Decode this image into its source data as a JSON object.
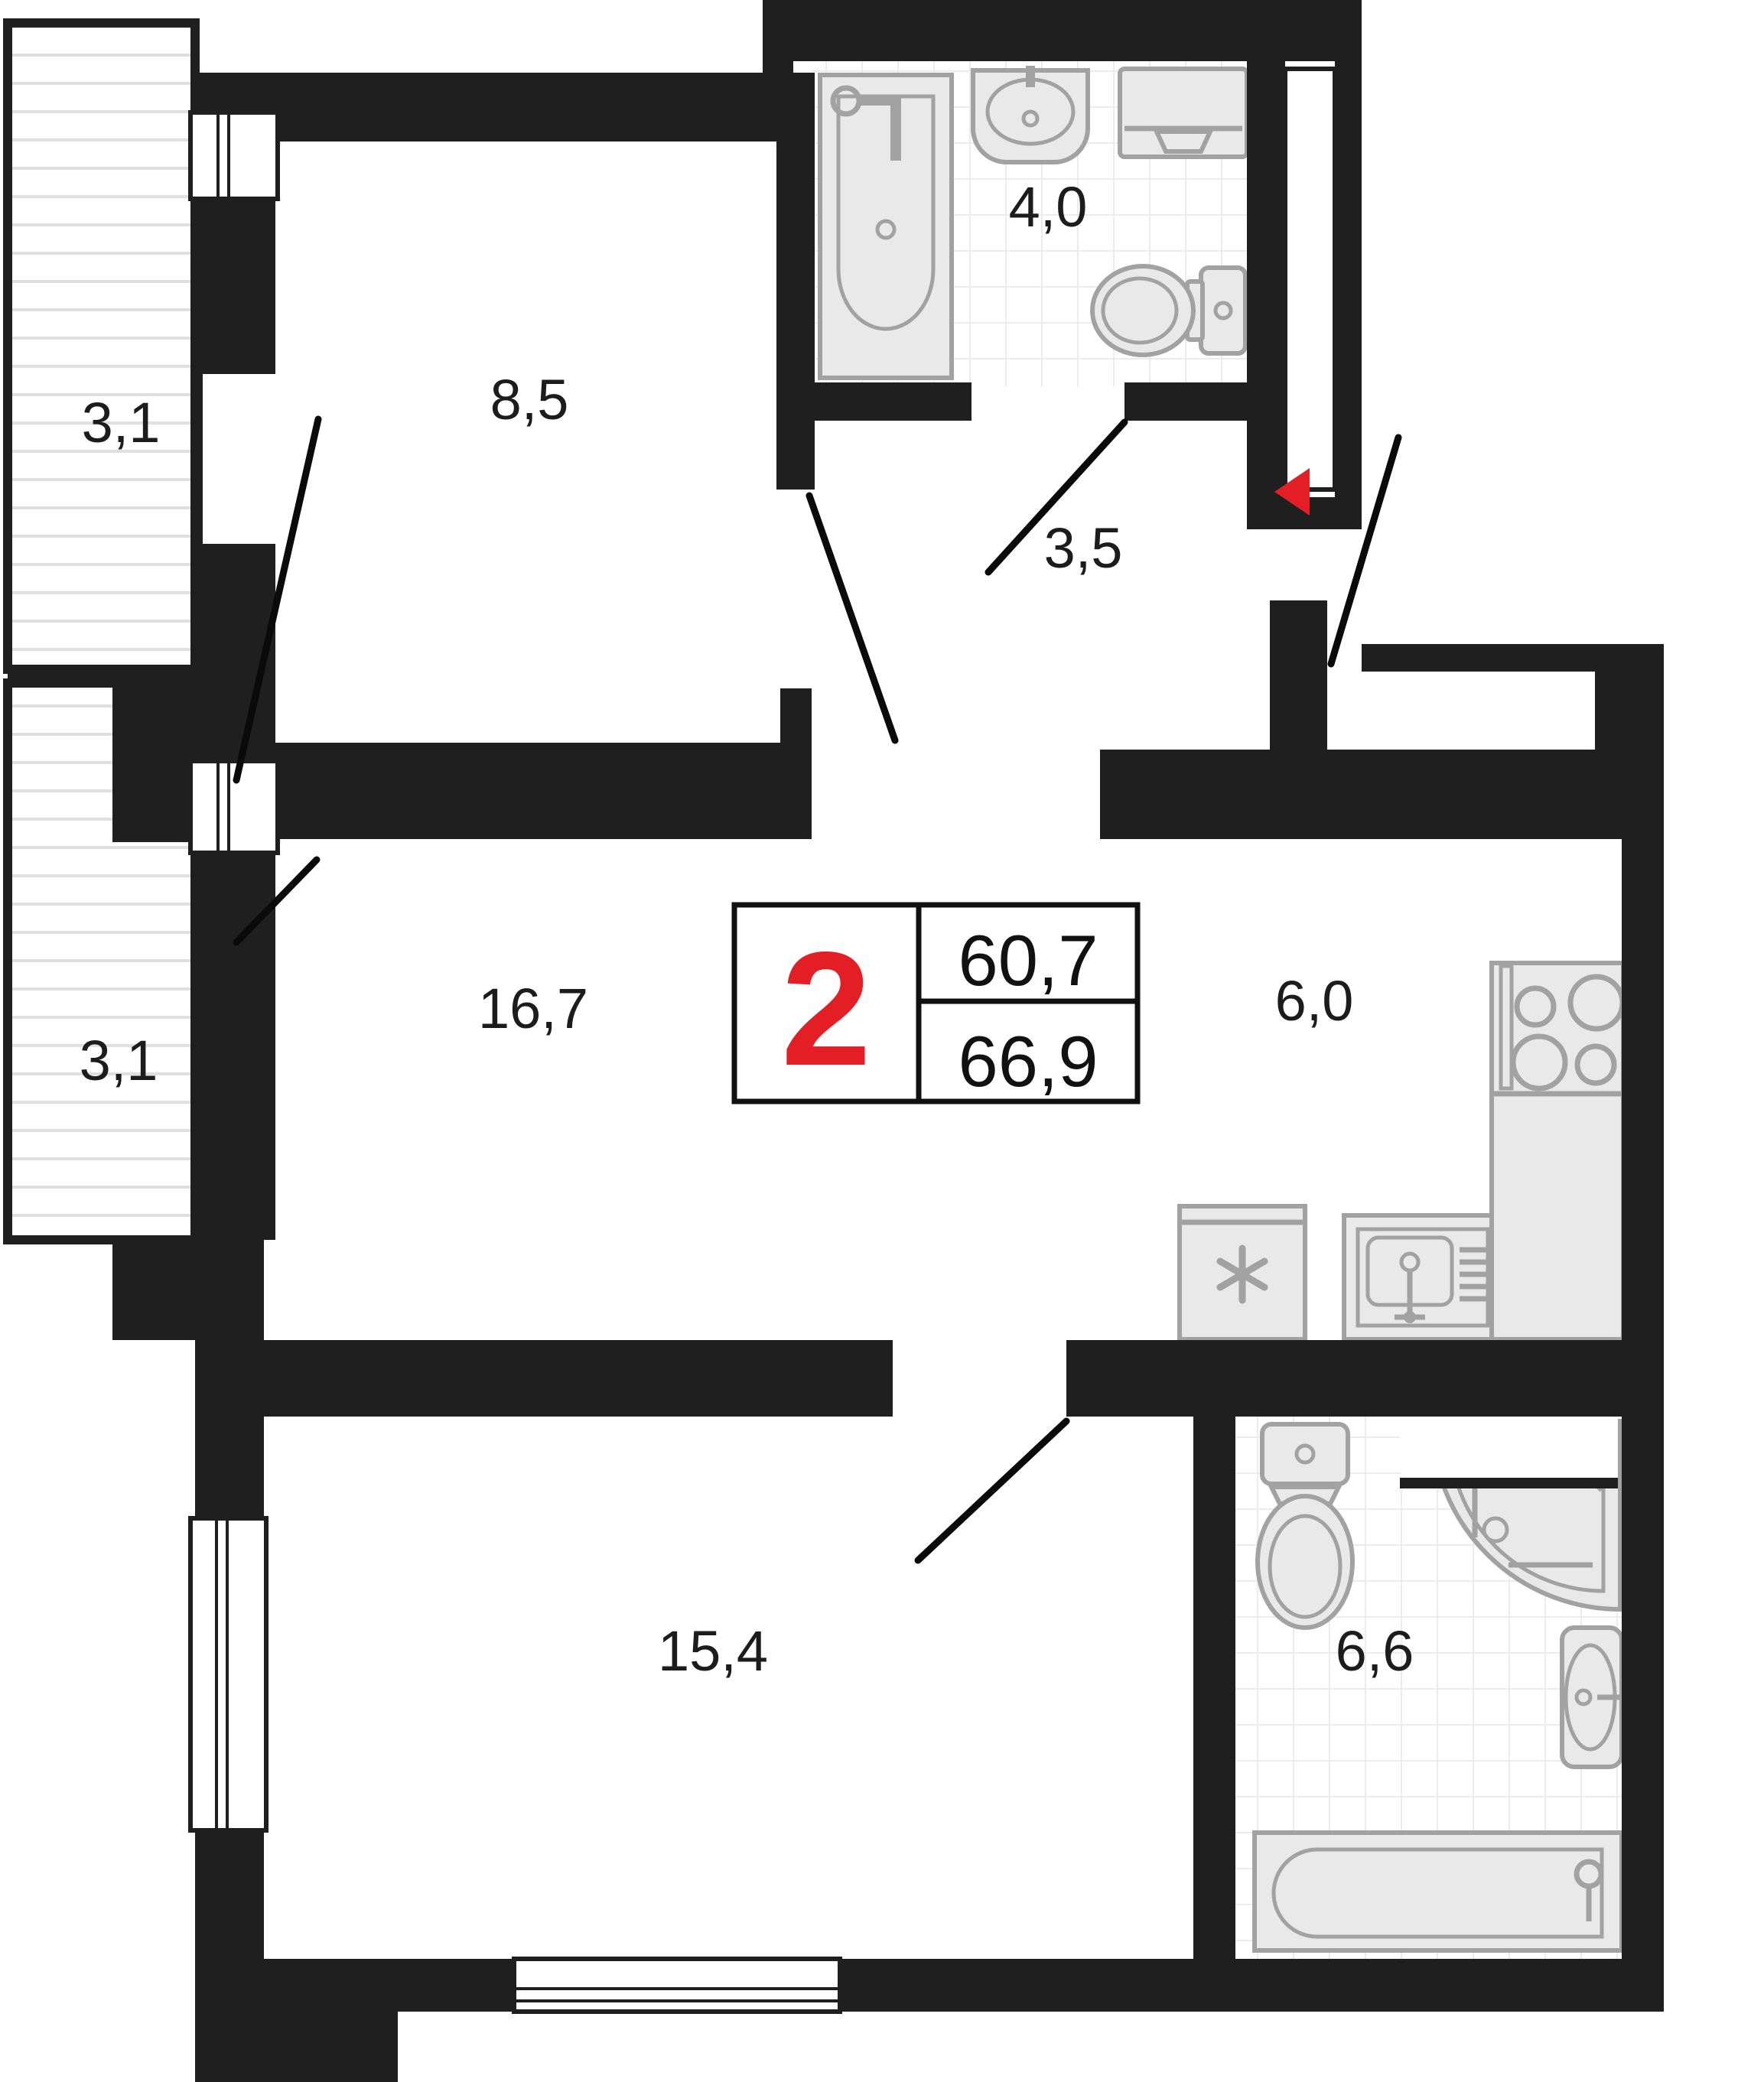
{
  "plan": {
    "type": "apartment-floor-plan",
    "badge": {
      "rooms_count": "2",
      "area_living": "60,7",
      "area_total": "66,9"
    },
    "rooms": [
      {
        "name": "balcony-top",
        "area": "3,1"
      },
      {
        "name": "bedroom",
        "area": "8,5"
      },
      {
        "name": "bathroom",
        "area": "4,0"
      },
      {
        "name": "hallway",
        "area": "3,5"
      },
      {
        "name": "balcony-bottom",
        "area": "3,1"
      },
      {
        "name": "living-room",
        "area": "16,7"
      },
      {
        "name": "kitchen",
        "area": "6,0"
      },
      {
        "name": "bedroom-2",
        "area": "15,4"
      },
      {
        "name": "bathroom-2",
        "area": "6,6"
      }
    ],
    "fixtures": [
      "bathtub",
      "wash-basin",
      "washing-machine",
      "toilet",
      "fridge",
      "kitchen-sink",
      "stove",
      "toilet-2",
      "corner-shower",
      "wash-basin-2",
      "bathtub-2"
    ],
    "colors": {
      "wall": "#1f1f1f",
      "accent_red": "#e31e24",
      "fixture_fill": "#e9e9e9",
      "fixture_stroke": "#a2a2a2",
      "tile_line": "#ececec",
      "deck_line": "#e0e0e0"
    }
  }
}
